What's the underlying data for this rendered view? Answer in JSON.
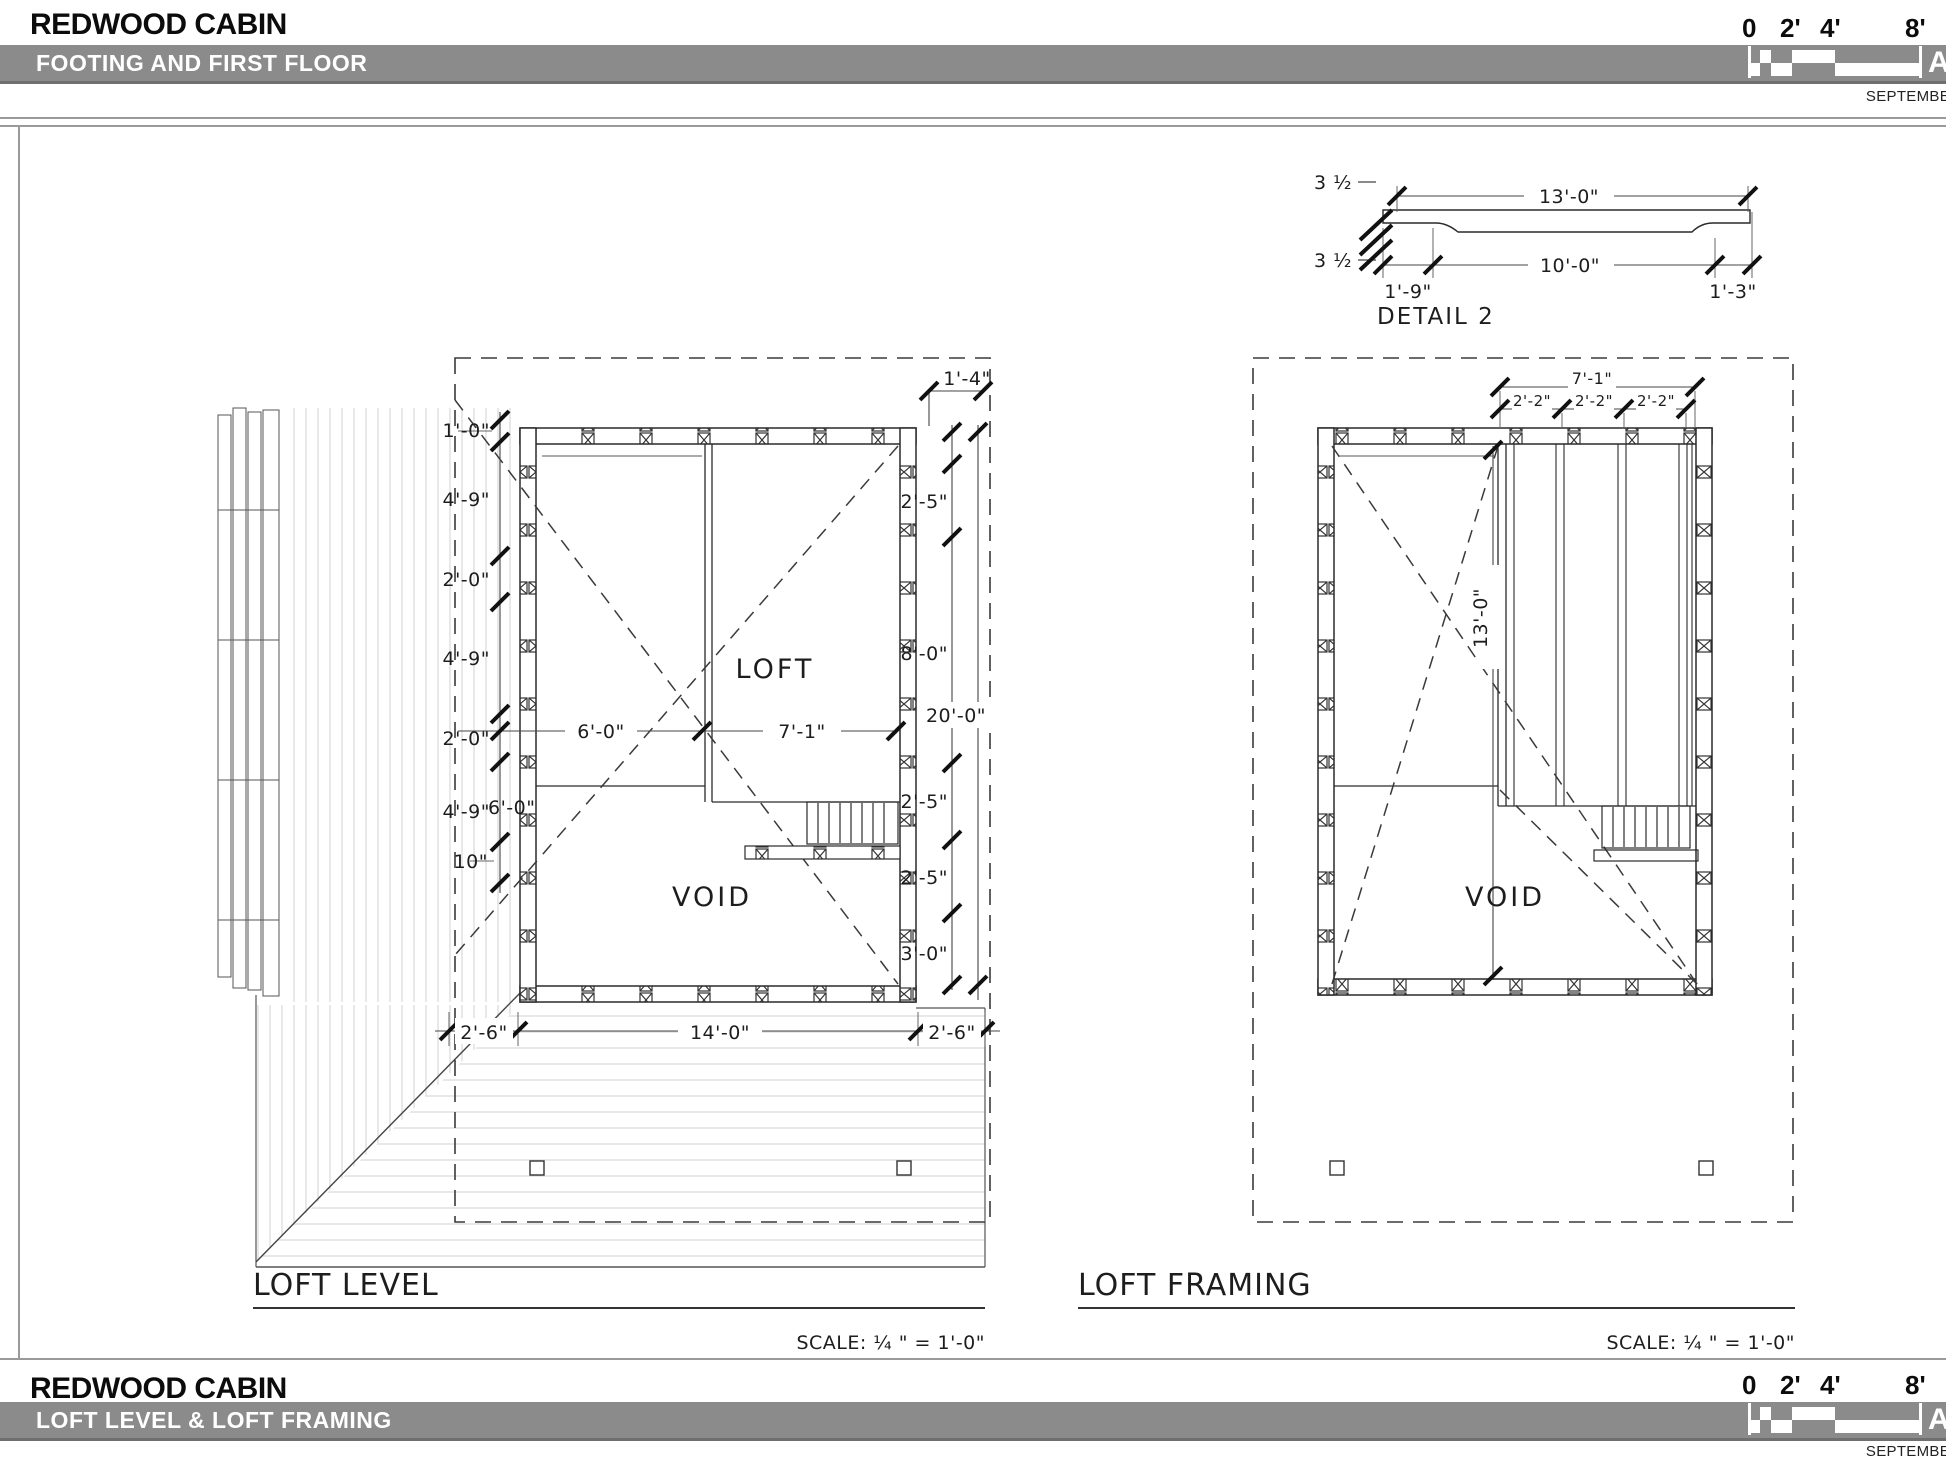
{
  "header": {
    "project": "REDWOOD CABIN",
    "sheet_title": "FOOTING AND FIRST FLOOR",
    "scale_ticks": [
      "0",
      "2'",
      "4'",
      "8'"
    ],
    "date": "SEPTEMBE",
    "sheet_letter": "A"
  },
  "footer": {
    "project": "REDWOOD CABIN",
    "sheet_title": "LOFT LEVEL & LOFT FRAMING",
    "scale_ticks": [
      "0",
      "2'",
      "4'",
      "8'"
    ],
    "date": "SEPTEMBE",
    "sheet_letter": "A"
  },
  "detail2": {
    "label": "DETAIL 2",
    "dim_overall": "13'-0\"",
    "dim_clear": "10'-0\"",
    "dim_left_bearing": "1'-9\"",
    "dim_right_bearing": "1'-3\"",
    "dim_depth_top": "3 ½",
    "dim_depth_bottom": "3 ½"
  },
  "loft_level": {
    "title": "LOFT LEVEL",
    "scale_note": "SCALE: ¼ \" =  1'-0\"",
    "label_loft": "LOFT",
    "label_void": "VOID",
    "left_dims": [
      "1'-0\"",
      "4'-9\"",
      "2'-0\"",
      "4'-9\"",
      "2'-0\"",
      "4'-9\"",
      "10\""
    ],
    "left_dim_overlap": "6'-0\"",
    "right_dims": [
      "1'-4\"",
      "2'-5\"",
      "8'-0\"",
      "20'-0\"",
      "2'-5\"",
      "2'-5\"",
      "3'-0\""
    ],
    "interior_dims": [
      "6'-0\"",
      "7'-1\""
    ],
    "bottom_dims": [
      "2'-6\"",
      "14'-0\"",
      "2'-6\""
    ]
  },
  "loft_framing": {
    "title": "LOFT FRAMING",
    "scale_note": "SCALE: ¼ \" =  1'-0\"",
    "label_void": "VOID",
    "dim_total_top": "7'-1\"",
    "top_dims": [
      "2'-2\"",
      "2'-2\"",
      "2'-2\""
    ],
    "dim_vertical": "13'-0\""
  }
}
